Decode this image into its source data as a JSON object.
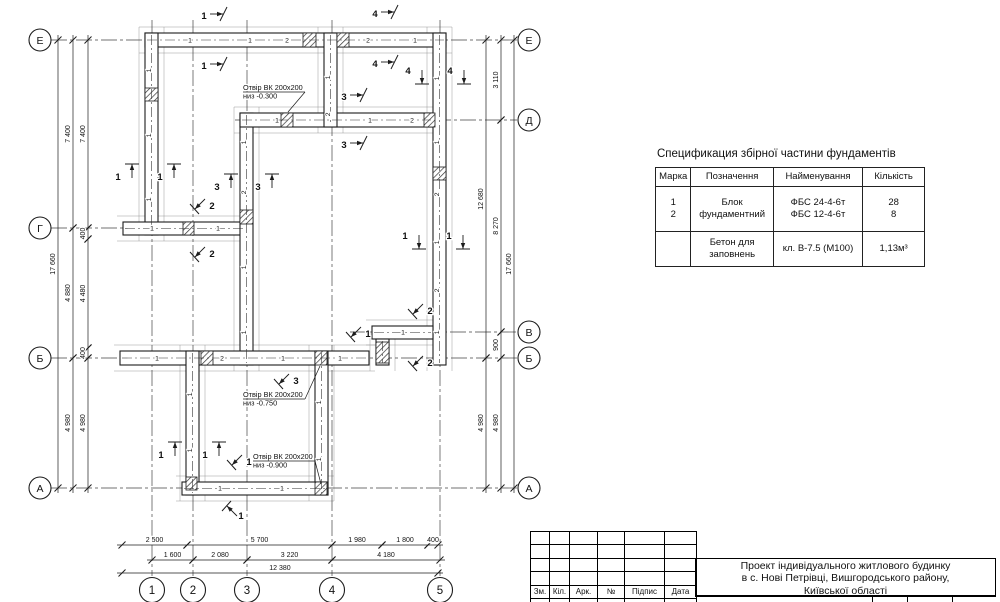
{
  "spec_table": {
    "title": "Спецификация збірної частини фундаментів",
    "headers": [
      "Марка",
      "Позначення",
      "Найменування",
      "Кількість"
    ],
    "rows": [
      {
        "marka": "1\n2",
        "poznachennya": "Блок\nфундаментний",
        "naimenuvannya": "ФБС 24-4-6т\nФБС 12-4-6т",
        "kilkist": "28\n8"
      },
      {
        "marka": " ",
        "poznachennya": "Бетон для\nзаповнень",
        "naimenuvannya": "кл. В-7.5 (М100)",
        "kilkist": "1,13м³"
      }
    ]
  },
  "title_block": {
    "columns": [
      "Зм.",
      "Кіл.",
      "Арк.",
      "№",
      "Підпис",
      "Дата"
    ],
    "project_title": [
      "Проект індивідуального житлового будинку",
      "в с. Нові Петрівці, Вишгородського району,",
      "Київської області"
    ]
  },
  "plan": {
    "line_color": "#1c1c1c",
    "walls": [
      [
        145,
        33,
        301,
        14
      ],
      [
        145,
        33,
        13,
        202
      ],
      [
        123,
        222,
        124,
        13
      ],
      [
        240,
        113,
        13,
        252
      ],
      [
        240,
        113,
        193,
        14
      ],
      [
        324,
        33,
        13,
        94
      ],
      [
        433,
        33,
        13,
        332
      ],
      [
        372,
        326,
        61,
        13
      ],
      [
        376,
        339,
        13,
        26
      ],
      [
        120,
        351,
        249,
        14
      ],
      [
        186,
        351,
        13,
        144
      ],
      [
        315,
        351,
        13,
        144
      ],
      [
        182,
        482,
        146,
        13
      ]
    ],
    "hatches": [
      [
        145,
        88,
        13,
        13
      ],
      [
        303,
        33,
        13,
        14
      ],
      [
        337,
        33,
        12,
        14
      ],
      [
        281,
        113,
        12,
        14
      ],
      [
        424,
        113,
        11,
        14
      ],
      [
        433,
        167,
        13,
        13
      ],
      [
        240,
        210,
        13,
        14
      ],
      [
        183,
        222,
        11,
        13
      ],
      [
        201,
        351,
        12,
        14
      ],
      [
        315,
        351,
        12,
        14
      ],
      [
        376,
        342,
        13,
        21
      ],
      [
        315,
        482,
        12,
        13
      ],
      [
        186,
        477,
        11,
        13
      ]
    ],
    "axes_h": [
      {
        "y": 40,
        "x1": 51,
        "x2": 517
      },
      {
        "y": 120,
        "x1": 235,
        "x2": 517
      },
      {
        "y": 228,
        "x1": 51,
        "x2": 252
      },
      {
        "y": 332,
        "x1": 350,
        "x2": 517
      },
      {
        "y": 358,
        "x1": 51,
        "x2": 517
      },
      {
        "y": 488,
        "x1": 51,
        "x2": 517
      }
    ],
    "axes_v": [
      {
        "x": 152,
        "y1": 20,
        "y2": 576
      },
      {
        "x": 193,
        "y1": 20,
        "y2": 576
      },
      {
        "x": 247,
        "y1": 20,
        "y2": 576
      },
      {
        "x": 332,
        "y1": 20,
        "y2": 576
      },
      {
        "x": 440,
        "y1": 20,
        "y2": 576
      }
    ],
    "bubbles": [
      {
        "label": "Е",
        "x": 40,
        "y": 40,
        "r": 11
      },
      {
        "label": "Г",
        "x": 40,
        "y": 228,
        "r": 11
      },
      {
        "label": "Б",
        "x": 40,
        "y": 358,
        "r": 11
      },
      {
        "label": "А",
        "x": 40,
        "y": 488,
        "r": 11
      },
      {
        "label": "Е",
        "x": 529,
        "y": 40,
        "r": 11
      },
      {
        "label": "Д",
        "x": 529,
        "y": 120,
        "r": 11
      },
      {
        "label": "В",
        "x": 529,
        "y": 332,
        "r": 11
      },
      {
        "label": "Б",
        "x": 529,
        "y": 358,
        "r": 11
      },
      {
        "label": "А",
        "x": 529,
        "y": 488,
        "r": 11
      },
      {
        "label": "1",
        "x": 152,
        "y": 590,
        "r": 12.5
      },
      {
        "label": "2",
        "x": 193,
        "y": 590,
        "r": 12.5
      },
      {
        "label": "3",
        "x": 247,
        "y": 590,
        "r": 12.5
      },
      {
        "label": "4",
        "x": 332,
        "y": 590,
        "r": 12.5
      },
      {
        "label": "5",
        "x": 440,
        "y": 590,
        "r": 12.5
      }
    ],
    "block_labels": [
      {
        "t": "1",
        "x": 190,
        "y": 40
      },
      {
        "t": "1",
        "x": 250,
        "y": 40
      },
      {
        "t": "2",
        "x": 287,
        "y": 40
      },
      {
        "t": "2",
        "x": 368,
        "y": 40
      },
      {
        "t": "1",
        "x": 415,
        "y": 40
      },
      {
        "t": "1",
        "x": 151,
        "y": 68,
        "r": 90
      },
      {
        "t": "1",
        "x": 151,
        "y": 133,
        "r": 90
      },
      {
        "t": "1",
        "x": 151,
        "y": 197,
        "r": 90
      },
      {
        "t": "1",
        "x": 330,
        "y": 75,
        "r": 90
      },
      {
        "t": "2",
        "x": 330,
        "y": 112,
        "r": 90
      },
      {
        "t": "1",
        "x": 277,
        "y": 120
      },
      {
        "t": "1",
        "x": 370,
        "y": 120
      },
      {
        "t": "2",
        "x": 412,
        "y": 120
      },
      {
        "t": "1",
        "x": 246,
        "y": 140,
        "r": 90
      },
      {
        "t": "2",
        "x": 246,
        "y": 190,
        "r": 90
      },
      {
        "t": "1",
        "x": 246,
        "y": 265,
        "r": 90
      },
      {
        "t": "1",
        "x": 246,
        "y": 330,
        "r": 90
      },
      {
        "t": "1",
        "x": 439,
        "y": 76,
        "r": 90
      },
      {
        "t": "1",
        "x": 439,
        "y": 140,
        "r": 90
      },
      {
        "t": "2",
        "x": 439,
        "y": 192,
        "r": 90
      },
      {
        "t": "1",
        "x": 439,
        "y": 240,
        "r": 90
      },
      {
        "t": "2",
        "x": 439,
        "y": 288,
        "r": 90
      },
      {
        "t": "1",
        "x": 439,
        "y": 330,
        "r": 90
      },
      {
        "t": "1",
        "x": 152,
        "y": 228
      },
      {
        "t": "1",
        "x": 218,
        "y": 228
      },
      {
        "t": "1",
        "x": 157,
        "y": 358
      },
      {
        "t": "2",
        "x": 222,
        "y": 358
      },
      {
        "t": "1",
        "x": 283,
        "y": 358
      },
      {
        "t": "1",
        "x": 340,
        "y": 358
      },
      {
        "t": "1",
        "x": 403,
        "y": 332
      },
      {
        "t": "1",
        "x": 192,
        "y": 392,
        "r": 90
      },
      {
        "t": "1",
        "x": 192,
        "y": 448,
        "r": 90
      },
      {
        "t": "1",
        "x": 321,
        "y": 400,
        "r": 90
      },
      {
        "t": "1",
        "x": 321,
        "y": 457,
        "r": 90
      },
      {
        "t": "1",
        "x": 220,
        "y": 488
      },
      {
        "t": "1",
        "x": 282,
        "y": 488
      }
    ],
    "markers": [
      {
        "n": "1",
        "x": 204,
        "y": 16,
        "type": "right"
      },
      {
        "n": "1",
        "x": 204,
        "y": 66,
        "type": "right"
      },
      {
        "n": "4",
        "x": 375,
        "y": 14,
        "type": "right"
      },
      {
        "n": "4",
        "x": 375,
        "y": 64,
        "type": "right"
      },
      {
        "n": "3",
        "x": 344,
        "y": 97,
        "type": "right"
      },
      {
        "n": "3",
        "x": 344,
        "y": 145,
        "type": "right"
      },
      {
        "n": "4",
        "x": 416,
        "y": 76,
        "type": "down"
      },
      {
        "n": "4",
        "x": 458,
        "y": 76,
        "type": "down"
      },
      {
        "n": "1",
        "x": 126,
        "y": 170,
        "type": "up"
      },
      {
        "n": "1",
        "x": 168,
        "y": 170,
        "type": "up"
      },
      {
        "n": "3",
        "x": 225,
        "y": 180,
        "type": "up"
      },
      {
        "n": "3",
        "x": 266,
        "y": 180,
        "type": "up"
      },
      {
        "n": "2",
        "x": 203,
        "y": 207,
        "type": "diag-dl"
      },
      {
        "n": "2",
        "x": 203,
        "y": 255,
        "type": "diag-dl"
      },
      {
        "n": "1",
        "x": 413,
        "y": 241,
        "type": "down"
      },
      {
        "n": "1",
        "x": 457,
        "y": 241,
        "type": "down"
      },
      {
        "n": "2",
        "x": 421,
        "y": 312,
        "type": "diag-dl"
      },
      {
        "n": "1",
        "x": 359,
        "y": 335,
        "type": "diag-dl"
      },
      {
        "n": "2",
        "x": 421,
        "y": 364,
        "type": "diag-dl"
      },
      {
        "n": "3",
        "x": 287,
        "y": 382,
        "type": "diag-dl"
      },
      {
        "n": "1",
        "x": 169,
        "y": 448,
        "type": "up"
      },
      {
        "n": "1",
        "x": 213,
        "y": 448,
        "type": "up"
      },
      {
        "n": "1",
        "x": 240,
        "y": 463,
        "type": "diag-dl"
      },
      {
        "n": "1",
        "x": 235,
        "y": 508,
        "type": "diag-ul"
      }
    ],
    "dims_v": [
      {
        "x": 58,
        "segs": [
          {
            "a": 40,
            "b": 488,
            "t": "17 660"
          }
        ]
      },
      {
        "x": 73,
        "segs": [
          {
            "a": 40,
            "b": 228,
            "t": "7 400"
          },
          {
            "a": 228,
            "b": 358,
            "t": "4 880"
          },
          {
            "a": 358,
            "b": 488,
            "t": "4 980"
          }
        ]
      },
      {
        "x": 88,
        "segs": [
          {
            "a": 40,
            "b": 228,
            "t": "7 400"
          },
          {
            "a": 228,
            "b": 239,
            "t": "400"
          },
          {
            "a": 239,
            "b": 348,
            "t": "4 480"
          },
          {
            "a": 348,
            "b": 358,
            "t": "400"
          },
          {
            "a": 358,
            "b": 488,
            "t": "4 980"
          }
        ]
      },
      {
        "x": 486,
        "segs": [
          {
            "a": 40,
            "b": 358,
            "t": "12 680"
          },
          {
            "a": 358,
            "b": 488,
            "t": "4 980"
          }
        ]
      },
      {
        "x": 501,
        "segs": [
          {
            "a": 40,
            "b": 120,
            "t": "3 110"
          },
          {
            "a": 120,
            "b": 332,
            "t": "8 270"
          },
          {
            "a": 332,
            "b": 358,
            "t": "900"
          },
          {
            "a": 358,
            "b": 488,
            "t": "4 980"
          }
        ]
      },
      {
        "x": 514,
        "segs": [
          {
            "a": 40,
            "b": 488,
            "t": "17 660"
          }
        ]
      }
    ],
    "dims_h": [
      {
        "y": 545,
        "segs": [
          {
            "a": 122,
            "b": 187,
            "t": "2 500"
          },
          {
            "a": 187,
            "b": 332,
            "t": "5 700"
          },
          {
            "a": 332,
            "b": 382,
            "t": "1 980"
          },
          {
            "a": 382,
            "b": 428,
            "t": "1 800"
          },
          {
            "a": 428,
            "b": 438,
            "t": "400"
          }
        ]
      },
      {
        "y": 560,
        "segs": [
          {
            "a": 152,
            "b": 193,
            "t": "1 600"
          },
          {
            "a": 193,
            "b": 247,
            "t": "2 080"
          },
          {
            "a": 247,
            "b": 332,
            "t": "3 220"
          },
          {
            "a": 332,
            "b": 440,
            "t": "4 180"
          }
        ]
      },
      {
        "y": 573,
        "segs": [
          {
            "a": 122,
            "b": 438,
            "t": "12 380"
          }
        ]
      }
    ],
    "notes": [
      {
        "l1": "Отвір ВК 200х200",
        "l2": "низ -0.300",
        "x": 243,
        "y": 90,
        "px": 305,
        "py": 92,
        "qx": 288,
        "qy": 112
      },
      {
        "l1": "Отвір ВК 200х200",
        "l2": "низ -0.750",
        "x": 243,
        "y": 397,
        "px": 305,
        "py": 399,
        "qx": 320,
        "qy": 366
      },
      {
        "l1": "Отвір ВК 200х200",
        "l2": "низ -0.900",
        "x": 253,
        "y": 459,
        "px": 315,
        "py": 461,
        "qx": 321,
        "qy": 484
      }
    ]
  }
}
